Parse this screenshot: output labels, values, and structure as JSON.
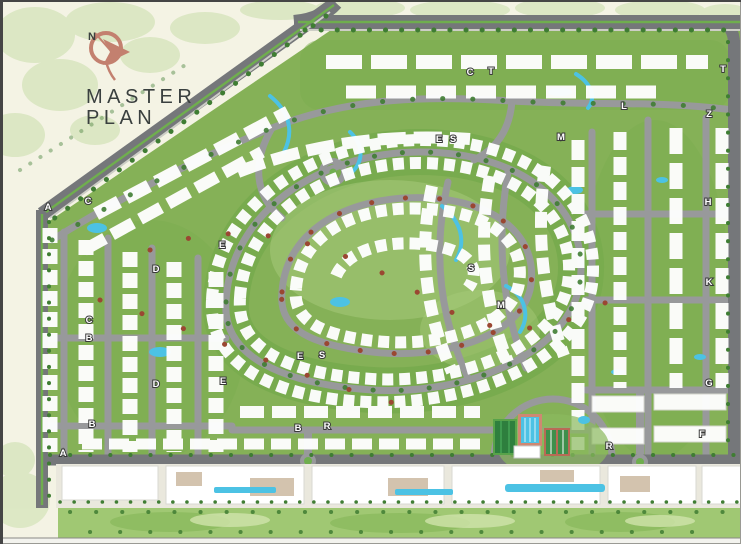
{
  "logo": {
    "compass_letter": "N",
    "title_line1": "MASTER",
    "title_line2": "PLAN"
  },
  "map": {
    "zone_labels": [
      {
        "label": "A",
        "x": 48,
        "y": 210
      },
      {
        "label": "C",
        "x": 88,
        "y": 204
      },
      {
        "label": "E",
        "x": 222,
        "y": 248
      },
      {
        "label": "D",
        "x": 156,
        "y": 272
      },
      {
        "label": "C",
        "x": 89,
        "y": 323
      },
      {
        "label": "B",
        "x": 89,
        "y": 341
      },
      {
        "label": "E",
        "x": 300,
        "y": 359
      },
      {
        "label": "S",
        "x": 322,
        "y": 358
      },
      {
        "label": "D",
        "x": 156,
        "y": 387
      },
      {
        "label": "E",
        "x": 223,
        "y": 384
      },
      {
        "label": "B",
        "x": 92,
        "y": 427
      },
      {
        "label": "A",
        "x": 63,
        "y": 456
      },
      {
        "label": "B",
        "x": 298,
        "y": 431
      },
      {
        "label": "R",
        "x": 327,
        "y": 429
      },
      {
        "label": "C",
        "x": 470,
        "y": 75
      },
      {
        "label": "T",
        "x": 491,
        "y": 74
      },
      {
        "label": "E",
        "x": 439,
        "y": 142
      },
      {
        "label": "S",
        "x": 453,
        "y": 142
      },
      {
        "label": "M",
        "x": 561,
        "y": 140
      },
      {
        "label": "L",
        "x": 624,
        "y": 109
      },
      {
        "label": "T",
        "x": 723,
        "y": 72
      },
      {
        "label": "Z",
        "x": 709,
        "y": 117
      },
      {
        "label": "H",
        "x": 708,
        "y": 205
      },
      {
        "label": "K",
        "x": 709,
        "y": 285
      },
      {
        "label": "S",
        "x": 471,
        "y": 271
      },
      {
        "label": "M",
        "x": 501,
        "y": 308
      },
      {
        "label": "G",
        "x": 709,
        "y": 386
      },
      {
        "label": "F",
        "x": 702,
        "y": 437
      },
      {
        "label": "R",
        "x": 609,
        "y": 449
      }
    ]
  },
  "palette": {
    "bg": "#f4f3e4",
    "land_green": "#85b157",
    "green_dark": "#6ca646",
    "green_light": "#a9cc7d",
    "foliage": "#d8e5bf",
    "road_dark": "#75777a",
    "road_light": "#98999b",
    "water": "#4cc2e4",
    "building": "#ffffff",
    "tree_green": "#3f7d33",
    "tree_red": "#9a4732",
    "commercial": "#eae8dd",
    "park_green": "#a0c873",
    "accent": "#c3806f",
    "title": "#3a403f",
    "label_outline": "#3a3a3a"
  }
}
